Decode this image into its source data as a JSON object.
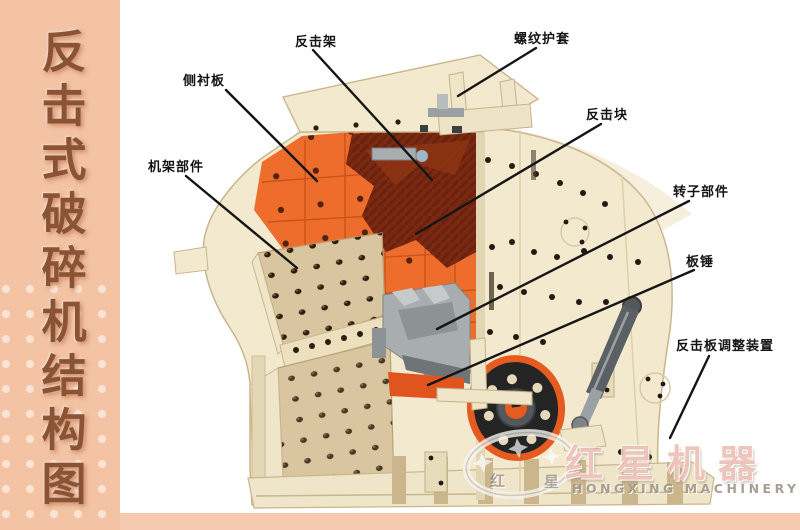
{
  "sidebar": {
    "title": "反击式破碎机结构图",
    "bg_color": "#f3c3a4",
    "text_color": "#8a5434"
  },
  "diagram": {
    "labels": [
      {
        "id": "impact-frame",
        "text": "反击架"
      },
      {
        "id": "threaded-sleeve",
        "text": "螺纹护套"
      },
      {
        "id": "side-liner-plate",
        "text": "侧衬板"
      },
      {
        "id": "frame-assembly",
        "text": "机架部件"
      },
      {
        "id": "impact-block",
        "text": "反击块"
      },
      {
        "id": "rotor-assembly",
        "text": "转子部件"
      },
      {
        "id": "blow-bar",
        "text": "板锤"
      },
      {
        "id": "impact-plate-adjuster",
        "text": "反击板调整装置"
      }
    ],
    "colors": {
      "body_cream": "#f2e9cf",
      "panel_tan": "#d9c6a0",
      "chamber_orange": "#ee6d2d",
      "impact_block_red": "#7c2912",
      "rotor_gray": "#a8adaf",
      "wheel_orange": "#e55b20",
      "wheel_black": "#242424"
    }
  },
  "watermark": {
    "logo_cn": "红星机器",
    "logo_en": "HONGXING MACHINERY",
    "emblem_char_1": "红",
    "emblem_char_2": "星"
  }
}
